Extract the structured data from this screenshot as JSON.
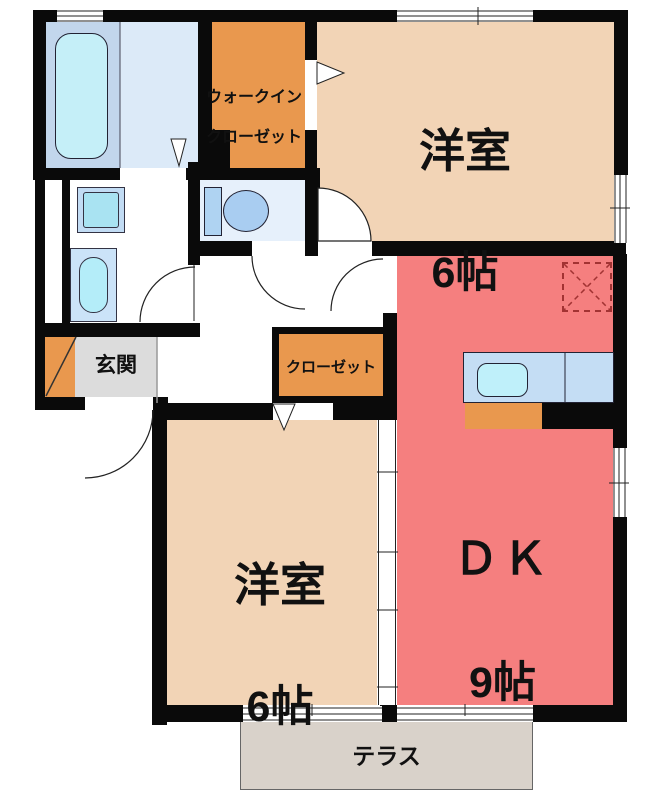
{
  "floor_plan": {
    "rooms": {
      "walk_in_closet": {
        "label_line1": "ウォークイン",
        "label_line2": "クローゼット"
      },
      "bedroom_top": {
        "name": "洋室",
        "size": "6帖"
      },
      "bedroom_bottom": {
        "name": "洋室",
        "size": "6帖"
      },
      "dining_kitchen": {
        "name": "ＤＫ",
        "size": "9帖"
      },
      "entrance": {
        "label": "玄関"
      },
      "closet": {
        "label": "クローゼット"
      },
      "terrace": {
        "label": "テラス"
      }
    },
    "colors": {
      "wall": "#0a0a0a",
      "room_peach": "#F2D4B6",
      "accent_orange": "#E9984E",
      "dk_salmon": "#F57F7F",
      "entrance_gray": "#DCDCDC",
      "terrace_beige": "#D9D2CA",
      "bath_zone_blue": "#C2D6EC",
      "bath_floor_blue": "#DCEAF8",
      "toilet_floor_blue": "#E6F0FB",
      "water_cyan": "#C5EFF8",
      "fixture_blue": "#C4DDF4",
      "fridge_dash_red": "#A23333"
    },
    "fixtures": [
      "bathtub",
      "washbasin",
      "washing-machine",
      "toilet",
      "kitchen-counter",
      "kitchen-sink",
      "stove",
      "refrigerator-space"
    ]
  }
}
